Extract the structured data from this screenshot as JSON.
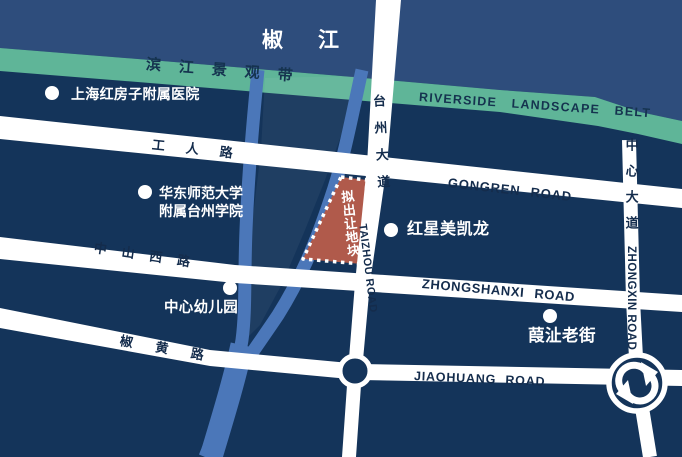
{
  "colors": {
    "background": "#14345a",
    "river_band": "#2e4d7c",
    "greenbelt": "#5fb598",
    "stream": "#4b77b9",
    "parcel_fill": "#b05a4b",
    "road": "#ffffff",
    "road_text": "#142c4c",
    "poi_text": "#ffffff"
  },
  "map": {
    "river_name": "椒江",
    "greenbelt": {
      "label_cn": "滨江景观带",
      "label_en": "RIVERSIDE LANDSCAPE BELT"
    },
    "parcel": {
      "label": "拟出让地块"
    },
    "roads": {
      "gongren_cn": "工人路",
      "gongren_en": "GONGREN ROAD",
      "zhongshanxi_cn": "中山西路",
      "zhongshanxi_en": "ZHONGSHANXI ROAD",
      "jiaohuang_cn": "椒黄路",
      "jiaohuang_en": "JIAOHUANG ROAD",
      "taizhou_cn": "台州大道",
      "taizhou_en": "TAIZHOU ROAD",
      "zhongxin_cn": "中心大道",
      "zhongxin_en": "ZHONGXIN ROAD"
    },
    "pois": [
      {
        "name": "上海红房子附属医院"
      },
      {
        "line1": "华东师范大学",
        "line2": "附属台州学院"
      },
      {
        "name": "红星美凯龙"
      },
      {
        "name": "中心幼儿园"
      },
      {
        "name": "葭沚老街"
      }
    ]
  }
}
